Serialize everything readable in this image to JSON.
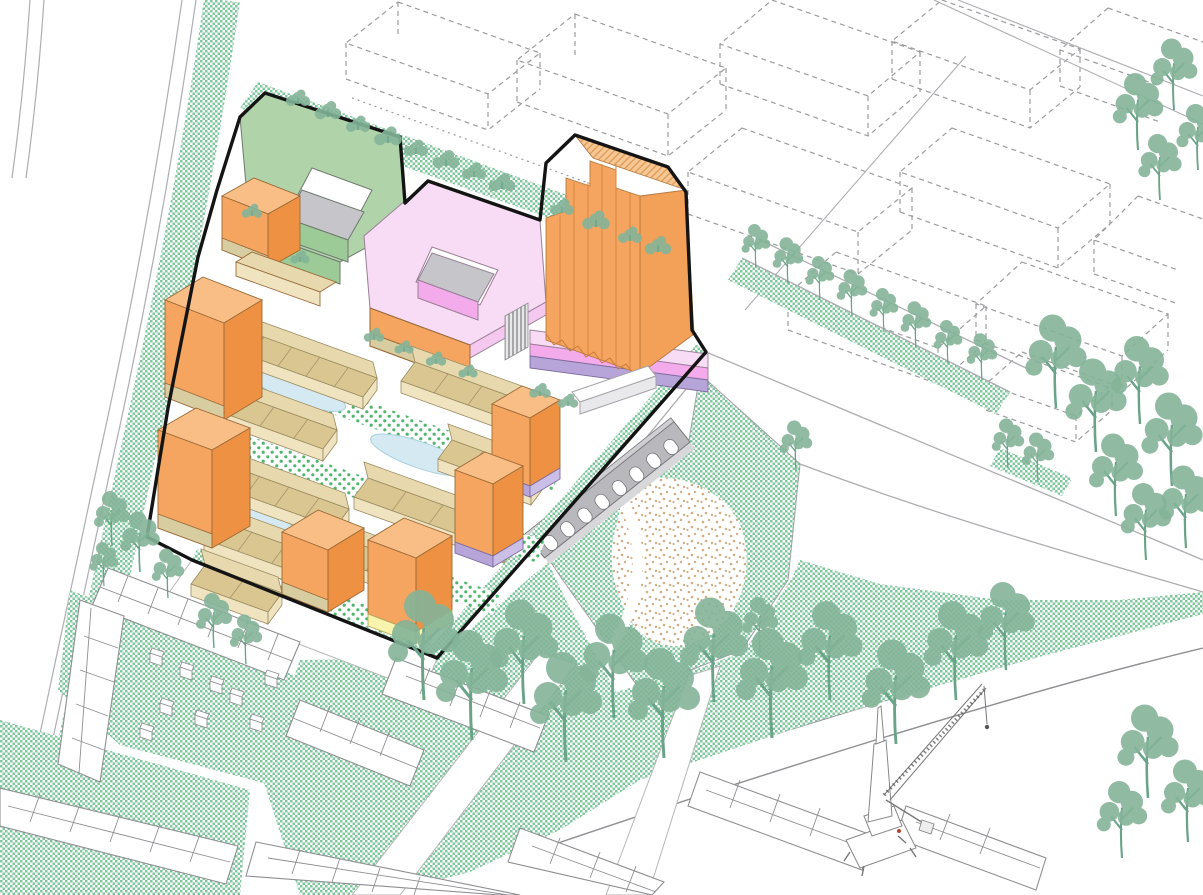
{
  "scene": {
    "description": "Axonometric urban masterplan illustration: colored proposed buildings inside a black site boundary, dashed future context blocks, park with arcade folly and sand play area, existing neighborhood in outline, street trees, harbor crane at the quay",
    "elements": [
      "development site boundary",
      "green courtyard building",
      "pink courtyard building",
      "orange residential tower on pink podium",
      "tan row houses with courtyard gardens and ponds",
      "orange perimeter blocks with purple and yellow plinths",
      "public park with grey arcade folly and sand play area",
      "existing neighborhood drawn in white outline",
      "planned context blocks drawn dashed",
      "street trees, hedges and lawns",
      "harbor crane",
      "quayside water"
    ]
  },
  "palette": {
    "outline": "#141414",
    "lineGray": "#8f8f93",
    "dashGray": "#9c9ca0",
    "roadGray": "#aeaeb2",
    "orangeTop": "#f9be86",
    "orangeMid": "#f5a55f",
    "orangeSide": "#f3a059",
    "orangeDark": "#ee9143",
    "orangeLine": "#d9863f",
    "tanBack": "#e7d9ad",
    "tanFront": "#d9c691",
    "tanWall": "#efe3c0",
    "tanBase": "#d8cda1",
    "tickBrown": "#a8946a",
    "greenRoof": "#b1d3aa",
    "greenSide": "#9ccb97",
    "courtGray": "#c6c6ca",
    "pinkTop": "#f8dbf4",
    "pinkMid": "#f5c8f0",
    "pinkBright": "#f3abec",
    "purpleBase": "#b7a5da",
    "lavender": "#cbbfe8",
    "yellowBase": "#f8f4ad",
    "pond": "#d4e9f2",
    "pondEdge": "#a9d0de",
    "grass": "#7fc79c",
    "gardenDot": "#4fb66e",
    "sandDot": "#d2ae84",
    "tree": "#84b499",
    "treeDark": "#6aa388",
    "arcadeGray": "#b9b9bd",
    "arcadeCap": "#cfcfd3",
    "arcadeLine": "#77777b",
    "white": "#ffffff"
  }
}
